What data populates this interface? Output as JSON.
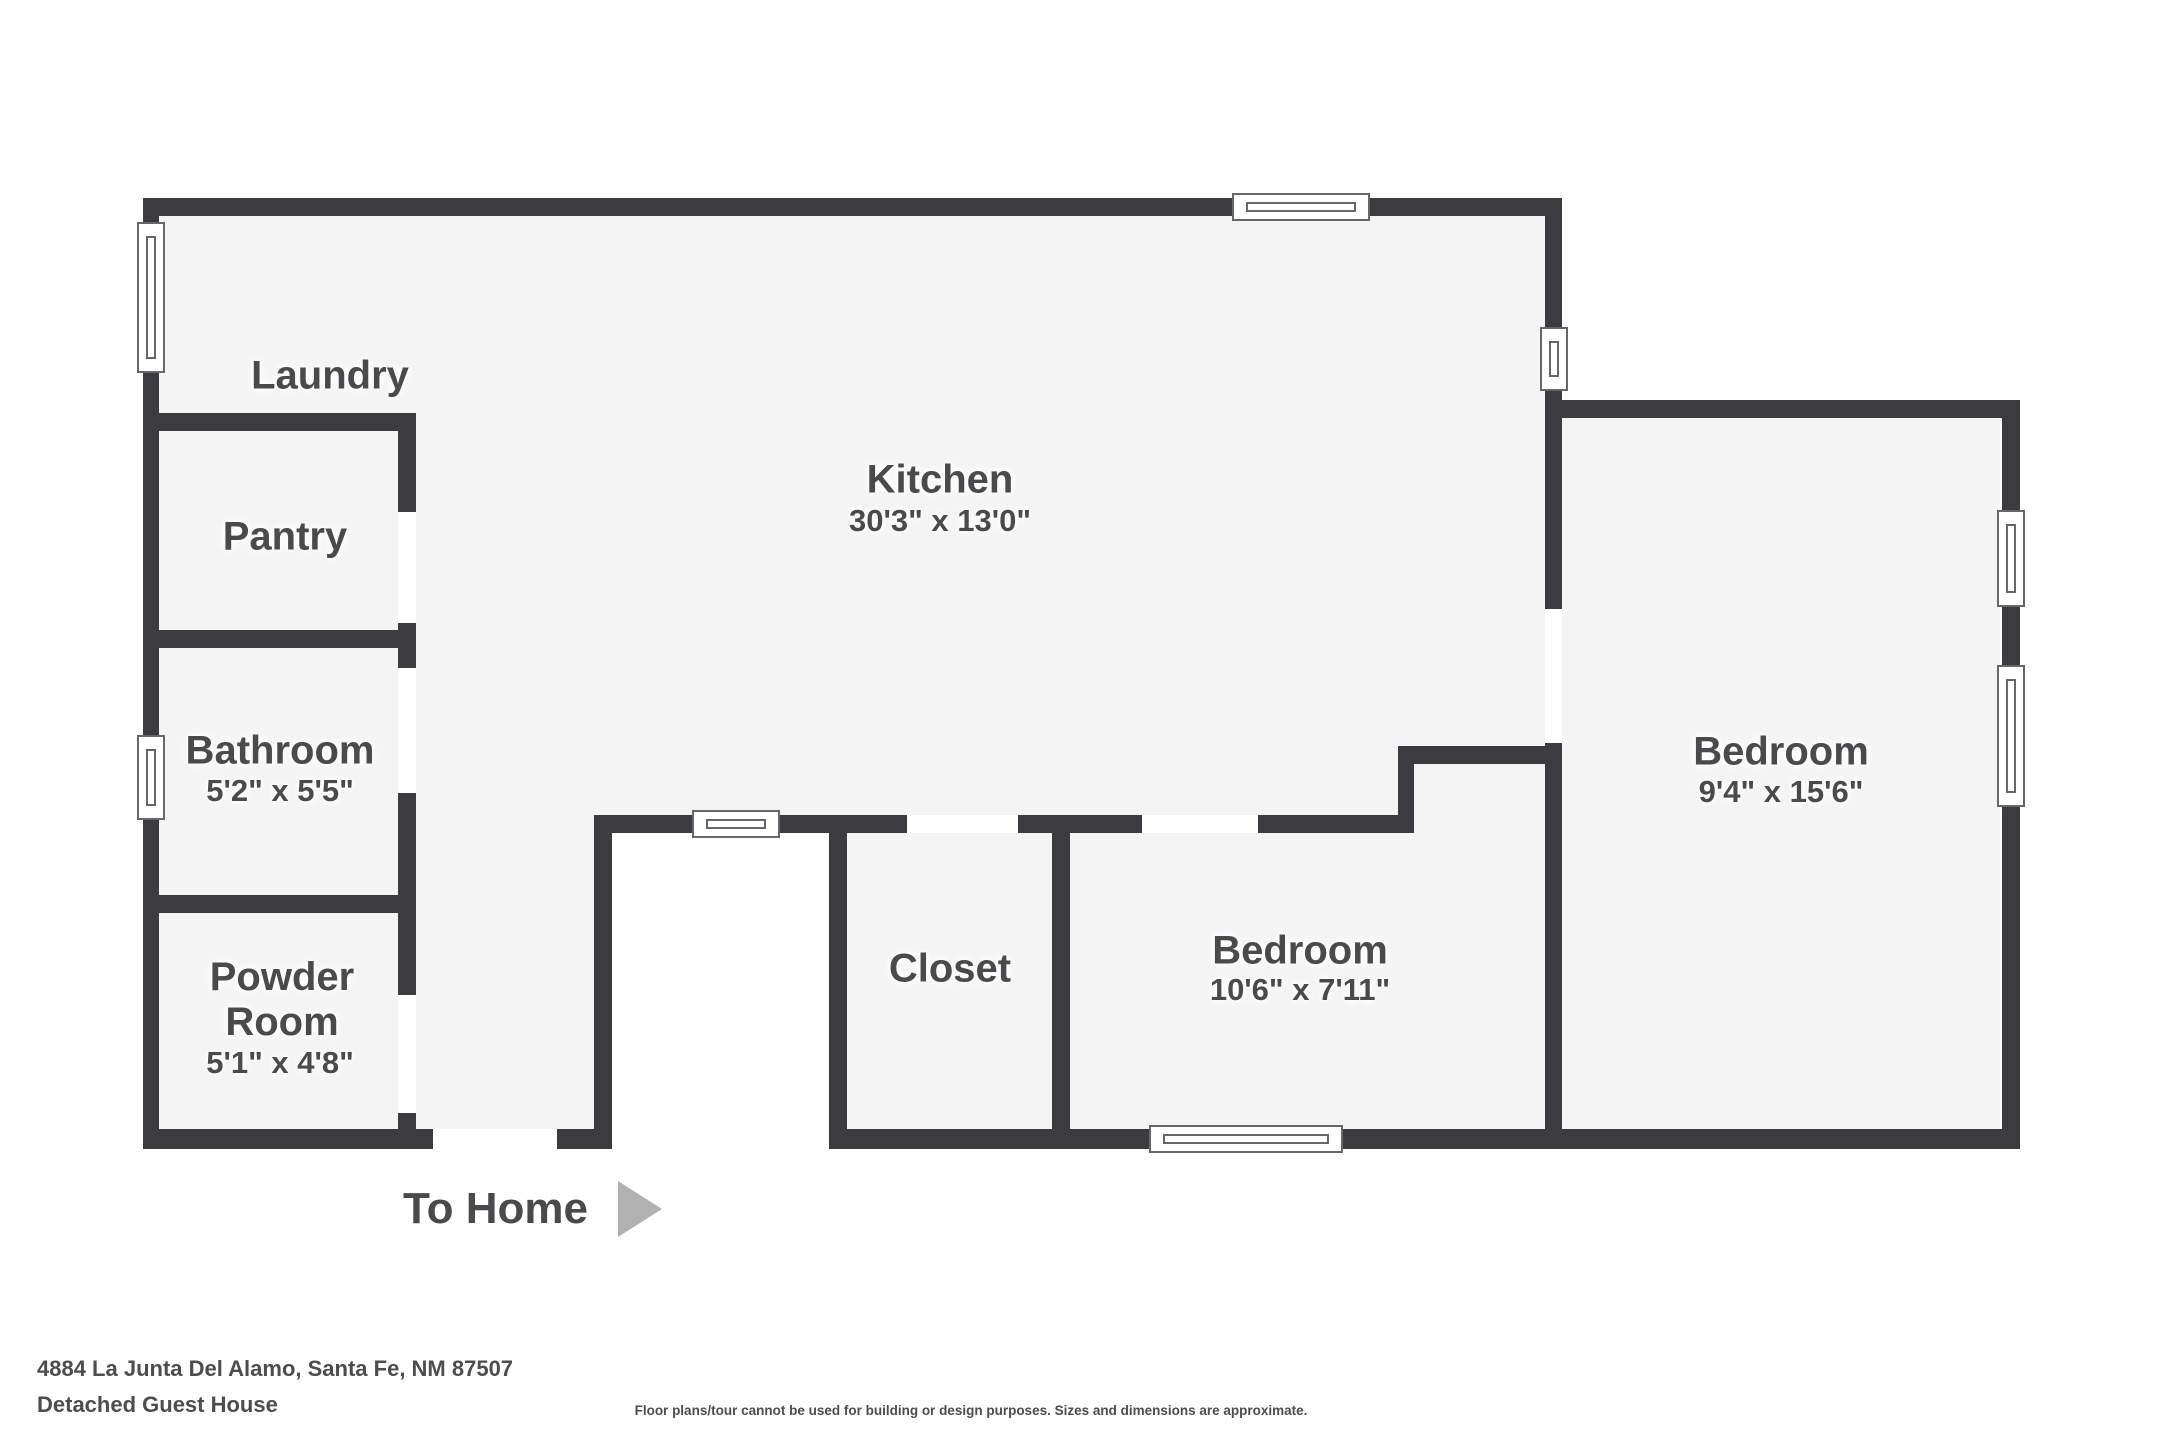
{
  "plan": {
    "rooms": {
      "laundry": {
        "name": "Laundry"
      },
      "pantry": {
        "name": "Pantry"
      },
      "kitchen": {
        "name": "Kitchen",
        "dims": "30'3\" x 13'0\""
      },
      "bathroom": {
        "name": "Bathroom",
        "dims": "5'2\" x 5'5\""
      },
      "powder_room": {
        "name": "Powder Room",
        "dims": "5'1\" x 4'8\""
      },
      "closet": {
        "name": "Closet"
      },
      "bedroom_small": {
        "name": "Bedroom",
        "dims": "10'6\" x 7'11\""
      },
      "bedroom_large": {
        "name": "Bedroom",
        "dims": "9'4\" x 15'6\""
      }
    },
    "entry": {
      "label": "To Home",
      "arrow_icon": "right-arrow-triangle"
    }
  },
  "footer": {
    "address": "4884 La Junta Del Alamo, Santa Fe, NM 87507",
    "subtitle": "Detached Guest House",
    "disclaimer": "Floor plans/tour cannot be used for building or design purposes. Sizes and dimensions are approximate."
  },
  "colors": {
    "wall": "#3c3c3e",
    "floor": "#f4f4f4",
    "label_text": "#4a4a4c",
    "arrow": "#b1b1b1",
    "window_border": "#66666b",
    "background": "#ffffff"
  }
}
